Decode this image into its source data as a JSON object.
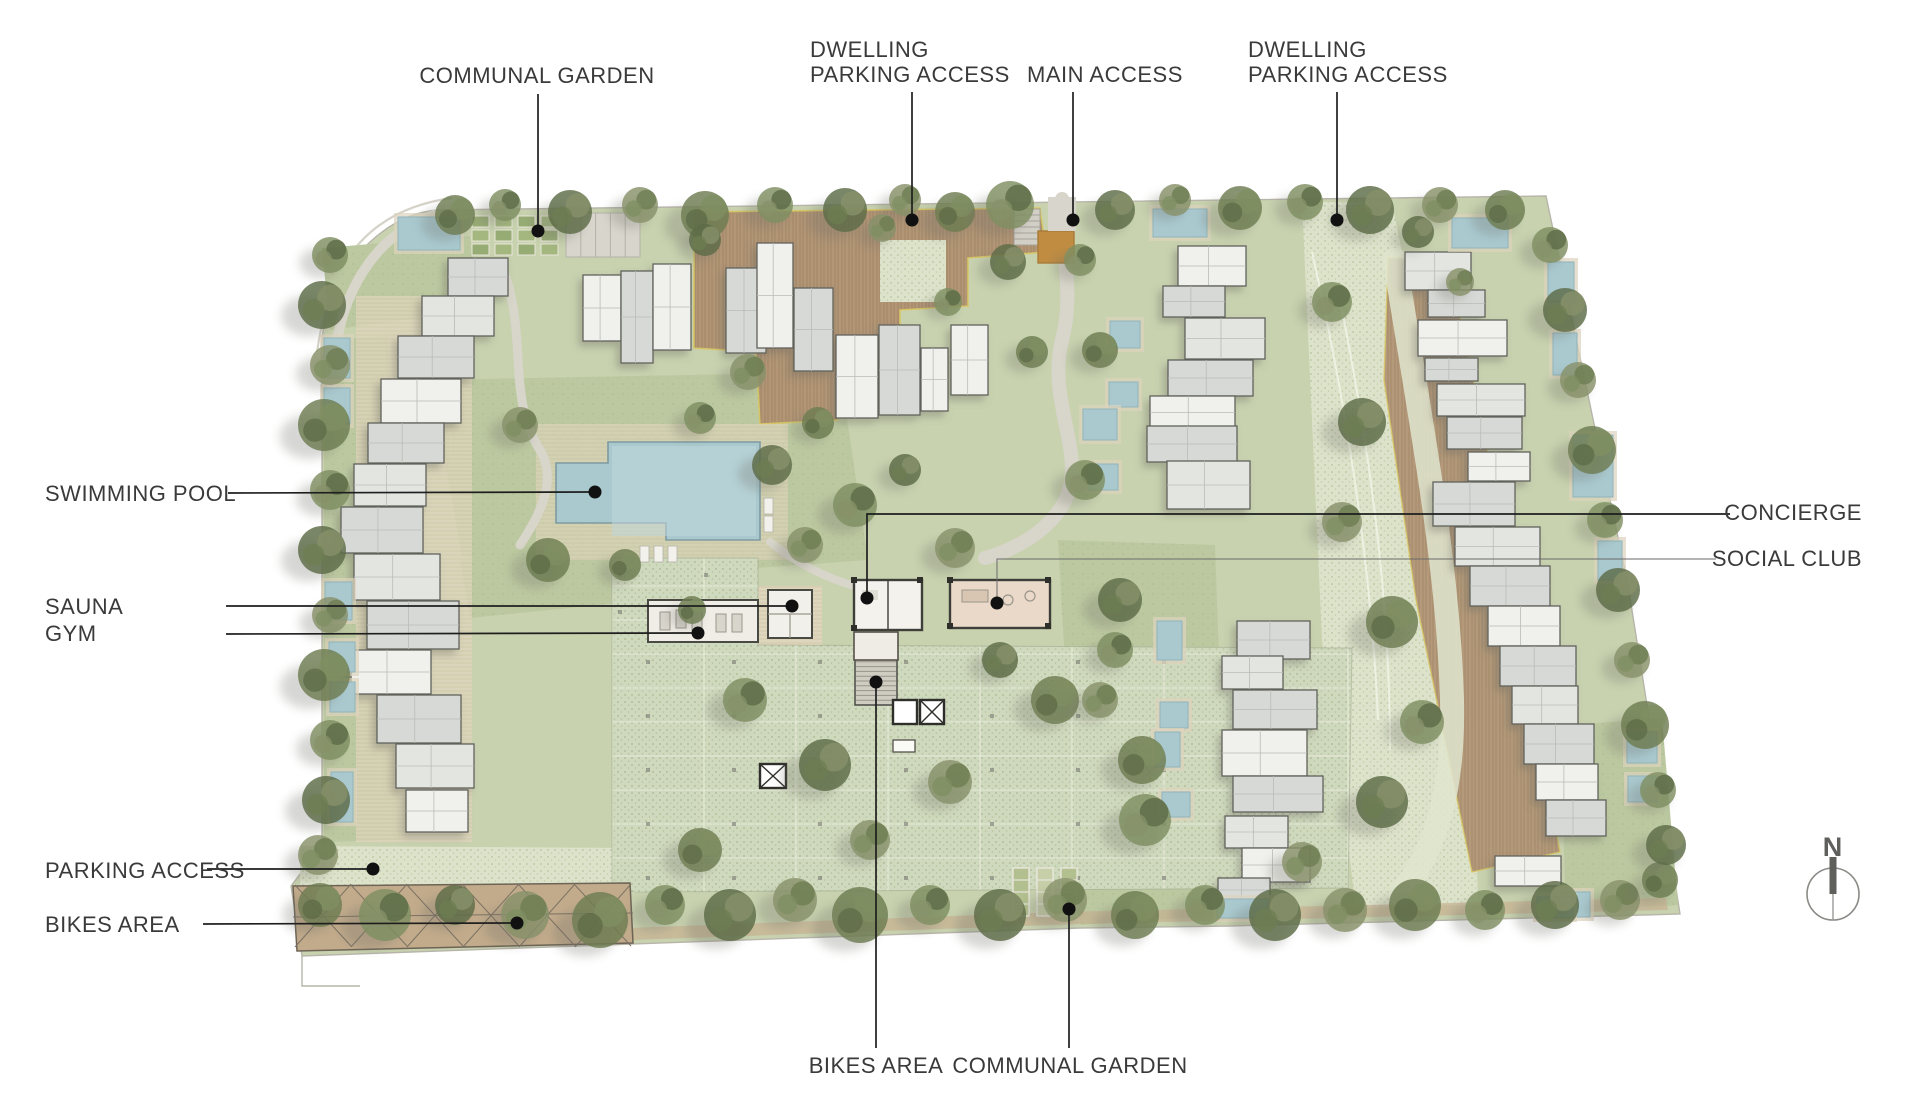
{
  "plan_title": "residential resort site plan",
  "north": {
    "letter": "N",
    "cx": 1833,
    "cy": 894,
    "r": 26
  },
  "palette": {
    "label_text": "#3a3a3a",
    "leader_line": "#1e1e1e",
    "leader_dot": "#111111",
    "site_green": "#c8d2af",
    "lawn_green": "#bcc9a0",
    "paver_pale": "#dde3cb",
    "parking_pale": "#cfd9bd",
    "pool_blue": "#a9c9cf",
    "pool_blue_light": "#c0d7da",
    "deck_brown": "#b29676",
    "deck_light": "#e4d7c0",
    "building_gray": "#d6d9d5",
    "building_light": "#e3e5e1",
    "building_white": "#f0f0ec",
    "building_outline": "#62625c",
    "tree_green": "#6e7d52",
    "tree_green_light": "#81906a",
    "shadow_gray": "#6f6f68",
    "canopy_tan": "#c2ab8b",
    "entry_orange": "#bf8c42",
    "trim_yellow": "#d9c763",
    "mulch_tan": "#c6b092",
    "path_gray": "#d8d5ca",
    "north_gray": "#5f5f5c"
  },
  "labels": [
    {
      "id": "communal-garden-top",
      "lines": [
        "COMMUNAL GARDEN"
      ],
      "x": 537,
      "y": 63,
      "anchor": "center",
      "leader": [
        [
          538,
          94
        ],
        [
          538,
          228
        ]
      ],
      "dot": [
        538,
        231
      ]
    },
    {
      "id": "dwelling-parking-access-left",
      "lines": [
        "DWELLING",
        "PARKING ACCESS"
      ],
      "x": 810,
      "y": 37,
      "anchor": "left",
      "leader": [
        [
          912,
          92
        ],
        [
          912,
          217
        ]
      ],
      "dot": [
        912,
        220
      ]
    },
    {
      "id": "main-access",
      "lines": [
        "MAIN ACCESS"
      ],
      "x": 1027,
      "y": 62,
      "anchor": "left",
      "leader": [
        [
          1073,
          92
        ],
        [
          1073,
          217
        ]
      ],
      "dot": [
        1073,
        220
      ]
    },
    {
      "id": "dwelling-parking-access-right",
      "lines": [
        "DWELLING",
        "PARKING ACCESS"
      ],
      "x": 1248,
      "y": 37,
      "anchor": "left",
      "leader": [
        [
          1337,
          92
        ],
        [
          1337,
          217
        ]
      ],
      "dot": [
        1337,
        220
      ]
    },
    {
      "id": "swimming-pool",
      "lines": [
        "SWIMMING POOL"
      ],
      "x": 45,
      "y": 481,
      "anchor": "left",
      "leader": [
        [
          228,
          493
        ],
        [
          590,
          492
        ]
      ],
      "dot": [
        595,
        492
      ]
    },
    {
      "id": "sauna",
      "lines": [
        "SAUNA"
      ],
      "x": 45,
      "y": 594,
      "anchor": "left",
      "leader": [
        [
          226,
          606
        ],
        [
          787,
          606
        ]
      ],
      "dot": [
        792,
        606
      ]
    },
    {
      "id": "gym",
      "lines": [
        "GYM"
      ],
      "x": 45,
      "y": 621,
      "anchor": "left",
      "leader": [
        [
          226,
          634
        ],
        [
          693,
          633
        ]
      ],
      "dot": [
        698,
        633
      ]
    },
    {
      "id": "concierge",
      "lines": [
        "CONCIERGE"
      ],
      "x": 58,
      "y": 500,
      "anchor": "right",
      "leader": [
        [
          1730,
          514
        ],
        [
          867,
          514
        ],
        [
          867,
          593
        ]
      ],
      "dot": [
        867,
        598
      ]
    },
    {
      "id": "social-club",
      "lines": [
        "SOCIAL CLUB"
      ],
      "x": 58,
      "y": 546,
      "anchor": "right",
      "leader": [
        [
          1716,
          559
        ],
        [
          997,
          559
        ],
        [
          997,
          598
        ]
      ],
      "dot": [
        997,
        603
      ],
      "thin": true
    },
    {
      "id": "parking-access",
      "lines": [
        "PARKING ACCESS"
      ],
      "x": 45,
      "y": 858,
      "anchor": "left",
      "leader": [
        [
          207,
          869
        ],
        [
          368,
          869
        ]
      ],
      "dot": [
        373,
        869
      ]
    },
    {
      "id": "bikes-area-left",
      "lines": [
        "BIKES AREA"
      ],
      "x": 45,
      "y": 912,
      "anchor": "left",
      "leader": [
        [
          203,
          924
        ],
        [
          512,
          923
        ]
      ],
      "dot": [
        517,
        923
      ]
    },
    {
      "id": "bikes-area-bottom",
      "lines": [
        "BIKES AREA"
      ],
      "x": 876,
      "y": 1053,
      "anchor": "center",
      "leader": [
        [
          876,
          1048
        ],
        [
          876,
          687
        ]
      ],
      "dot": [
        876,
        682
      ]
    },
    {
      "id": "communal-garden-bottom",
      "lines": [
        "COMMUNAL GARDEN"
      ],
      "x": 1070,
      "y": 1053,
      "anchor": "center",
      "leader": [
        [
          1069,
          1048
        ],
        [
          1069,
          913
        ]
      ],
      "dot": [
        1069,
        909
      ]
    }
  ]
}
